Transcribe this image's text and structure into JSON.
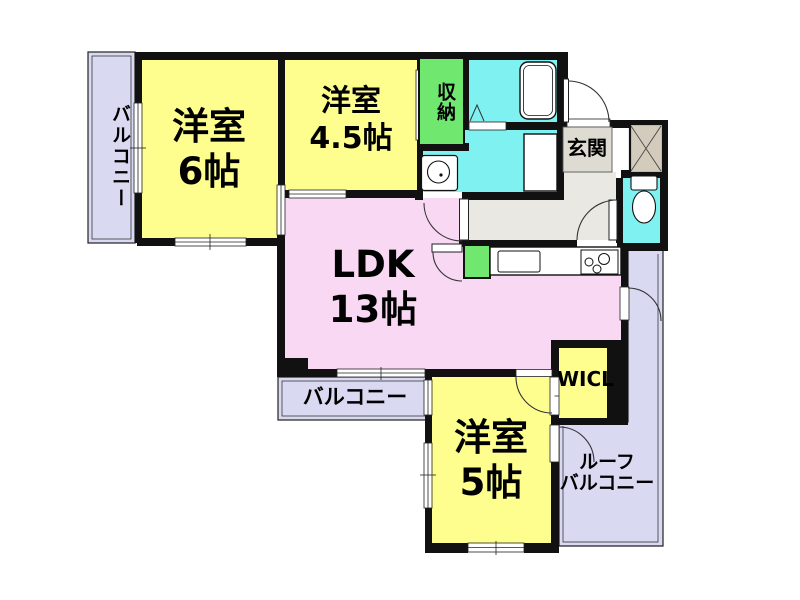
{
  "rooms": {
    "western6": {
      "name": "洋室",
      "size": "6帖"
    },
    "western45": {
      "name": "洋室",
      "size": "4.5帖"
    },
    "ldk": {
      "name": "LDK",
      "size": "13帖"
    },
    "western5": {
      "name": "洋室",
      "size": "5帖"
    },
    "storage": {
      "label": "収納"
    },
    "entrance": {
      "label": "玄関"
    },
    "wicl": {
      "label": "WICL"
    },
    "balcony_left": {
      "label": "バルコニー"
    },
    "balcony_bottom": {
      "label": "バルコニー"
    },
    "roof_balcony": {
      "line1": "ルーフ",
      "line2": "バルコニー"
    }
  },
  "colors": {
    "room_yellow": "#FEFE8E",
    "ldk_pink": "#F8D8F2",
    "wet_area_cyan": "#7FF1F1",
    "storage_green": "#70E870",
    "balcony_lavender": "#D9D9F2",
    "hallway_gray": "#E9E8E2",
    "entrance_gray": "#DEDCD2",
    "shaft_beige": "#D3CCBC",
    "wall": "#111111"
  }
}
